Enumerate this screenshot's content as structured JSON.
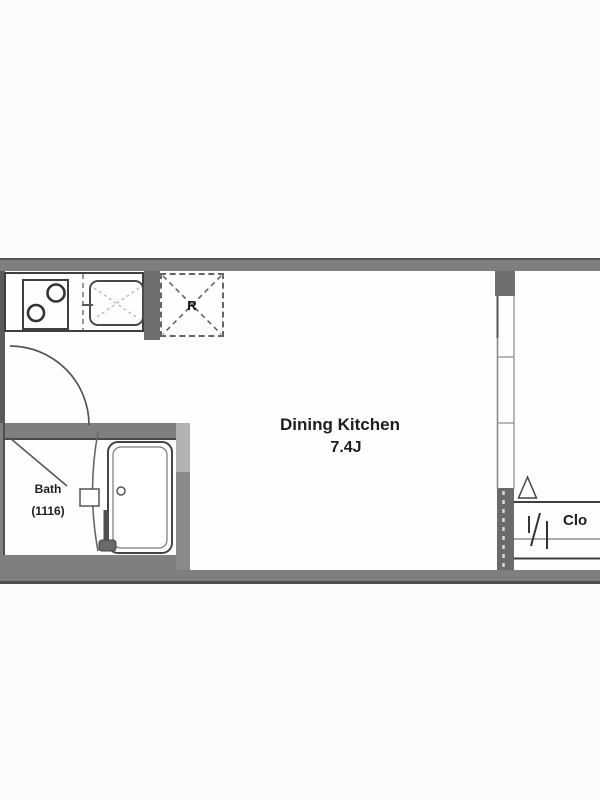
{
  "floorplan": {
    "rooms": {
      "dining_kitchen": {
        "name": "Dining Kitchen",
        "size": "7.4J"
      },
      "bath": {
        "name": "Bath",
        "size": "(1116)"
      },
      "closet": {
        "label": "Clo"
      },
      "refrigerator": {
        "label": "R"
      }
    },
    "fixtures": [
      "stove-burners-icon",
      "sink-icon",
      "refrigerator-icon",
      "bathtub-icon",
      "bath-faucet-icon",
      "door-swing-arc-icon",
      "sliding-door-icon",
      "folding-door-icon"
    ],
    "colors": {
      "wall": "#7f7f7f",
      "wall-dark": "#6e6e6e",
      "wall-darker": "#565656",
      "wall-light": "#b2b2b2",
      "wall-mid": "#8a8a8a",
      "line": "#3f3f3f",
      "floor": "#fefefe",
      "bg": "#fcfcfc",
      "text": "#1e1e1e"
    }
  }
}
